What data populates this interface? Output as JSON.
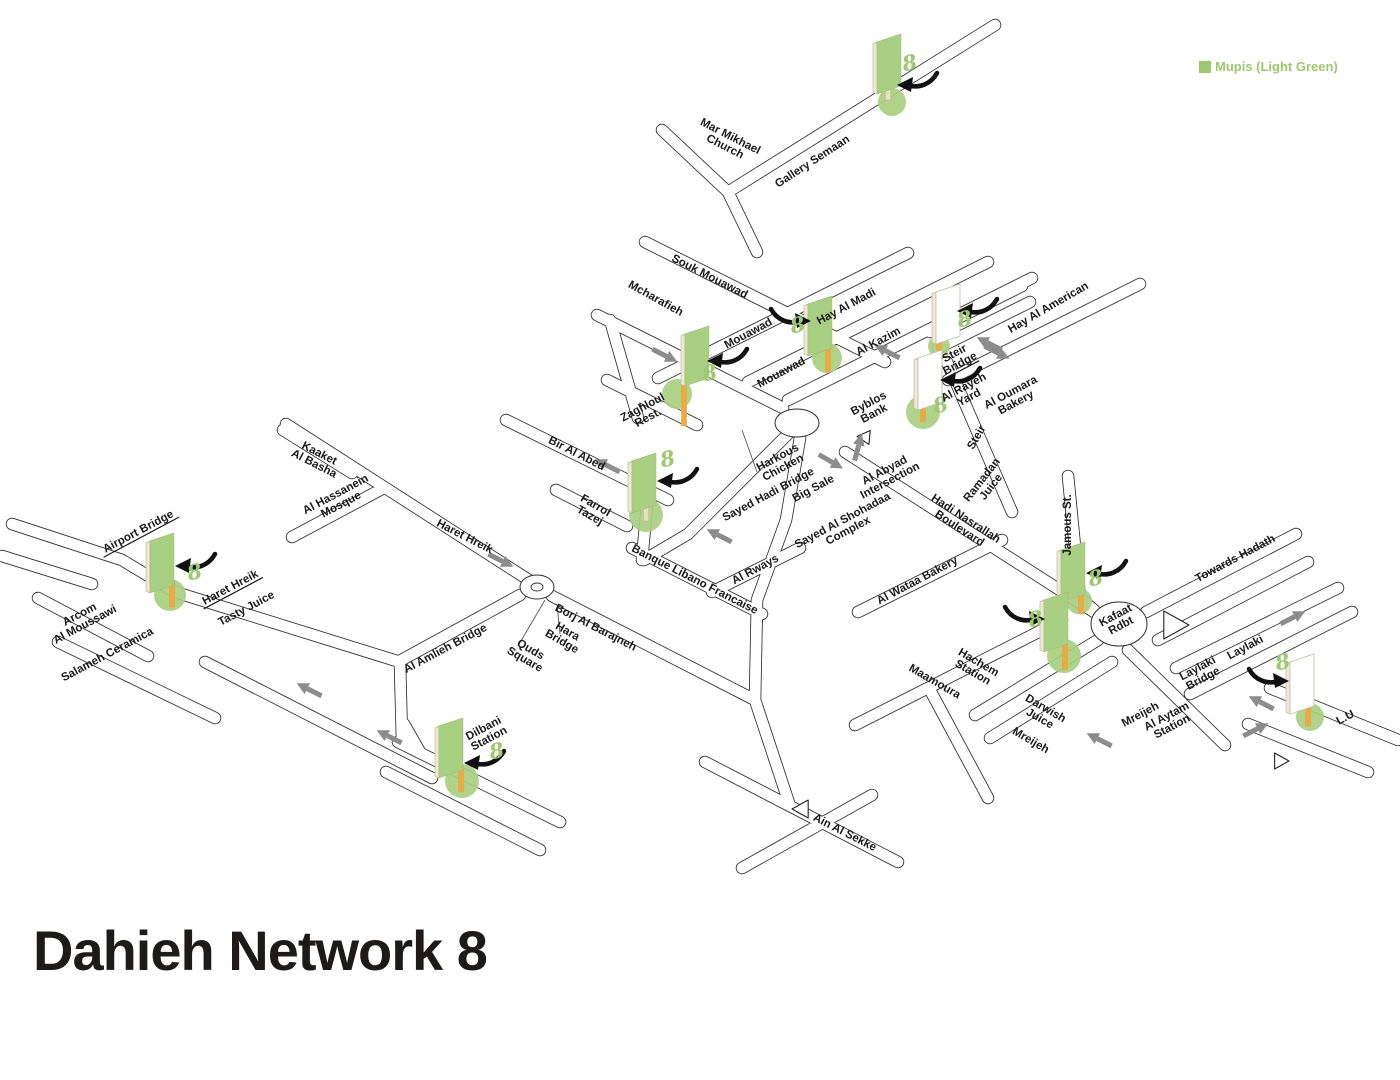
{
  "title": "Dahieh Network 8",
  "legend": {
    "label": "Mupis (Light Green)",
    "color": "#9CC96F"
  },
  "colors": {
    "legend_green": "#9CC96F",
    "mupi_panel_green": "#A9CF82",
    "mupi_panel_back": "#FFFFFF",
    "mupi_edge_cream": "#EFE8D3",
    "mupi_edge_stroke": "#C9C1A8",
    "pole_orange": "#F2A93B",
    "pole_cream": "#E7DEC8",
    "base_circle_green": "#A9CF82",
    "road_line": "#2E2E2E",
    "road_fill": "#FFFFFF",
    "direction_arrow_gray": "#8C8C8C",
    "label_text": "#1A1A1A",
    "marker_arrow_black": "#111111"
  },
  "map": {
    "street_labels": [
      {
        "lines": [
          "Mar Mikhael",
          "Church"
        ],
        "x": 728,
        "y": 141,
        "rot": 27,
        "ul": false
      },
      {
        "lines": [
          "Gallery Semaan"
        ],
        "x": 812,
        "y": 161,
        "rot": -33,
        "ul": false
      },
      {
        "lines": [
          "Souk Mouawad"
        ],
        "x": 710,
        "y": 276,
        "rot": 27,
        "ul": false
      },
      {
        "lines": [
          "Mcharafieh"
        ],
        "x": 656,
        "y": 298,
        "rot": 29,
        "ul": false
      },
      {
        "lines": [
          "Mouawad"
        ],
        "x": 748,
        "y": 333,
        "rot": -28,
        "ul": false
      },
      {
        "lines": [
          "Mouawad"
        ],
        "x": 781,
        "y": 372,
        "rot": -28,
        "ul": false
      },
      {
        "lines": [
          "Hay Al Madi"
        ],
        "x": 846,
        "y": 306,
        "rot": -28,
        "ul": false
      },
      {
        "lines": [
          "Al Kazim"
        ],
        "x": 878,
        "y": 341,
        "rot": -28,
        "ul": false
      },
      {
        "lines": [
          "Hay Al American"
        ],
        "x": 1048,
        "y": 307,
        "rot": -30,
        "ul": false
      },
      {
        "lines": [
          "Steir",
          "Bridge"
        ],
        "x": 957,
        "y": 358,
        "rot": -28,
        "ul": true
      },
      {
        "lines": [
          "Al Rayeh",
          "Yard"
        ],
        "x": 966,
        "y": 392,
        "rot": -28,
        "ul": false
      },
      {
        "lines": [
          "Al Oumara",
          "Bakery"
        ],
        "x": 1013,
        "y": 397,
        "rot": -28,
        "ul": false
      },
      {
        "lines": [
          "Byblos",
          "Bank"
        ],
        "x": 871,
        "y": 408,
        "rot": -28,
        "ul": false
      },
      {
        "lines": [
          "Zaghloul",
          "Rest."
        ],
        "x": 645,
        "y": 412,
        "rot": -28,
        "ul": false
      },
      {
        "lines": [
          "Bir Al Abed"
        ],
        "x": 577,
        "y": 453,
        "rot": 27,
        "ul": false
      },
      {
        "lines": [
          "Harkous",
          "Chicken"
        ],
        "x": 780,
        "y": 462,
        "rot": -28,
        "ul": false
      },
      {
        "lines": [
          "Sayed Hadi Bridge"
        ],
        "x": 768,
        "y": 494,
        "rot": -28,
        "ul": false
      },
      {
        "lines": [
          "Big Sale"
        ],
        "x": 813,
        "y": 488,
        "rot": -28,
        "ul": false
      },
      {
        "lines": [
          "Al Abyad",
          "Intersection"
        ],
        "x": 887,
        "y": 475,
        "rot": -28,
        "ul": false
      },
      {
        "lines": [
          "Ramadan",
          "Juice"
        ],
        "x": 986,
        "y": 483,
        "rot": -52,
        "ul": false
      },
      {
        "lines": [
          "Steir"
        ],
        "x": 976,
        "y": 437,
        "rot": -60,
        "ul": false
      },
      {
        "lines": [
          "Kaaket",
          "Al Basha"
        ],
        "x": 317,
        "y": 458,
        "rot": 27,
        "ul": false
      },
      {
        "lines": [
          "Al Hassanein",
          "Mosque"
        ],
        "x": 338,
        "y": 499,
        "rot": -28,
        "ul": false
      },
      {
        "lines": [
          "Haret Hreik"
        ],
        "x": 465,
        "y": 536,
        "rot": 27,
        "ul": false
      },
      {
        "lines": [
          "Farrol",
          "Tazej"
        ],
        "x": 593,
        "y": 510,
        "rot": 30,
        "ul": false
      },
      {
        "lines": [
          "Sayed Al Shohadaa",
          "Complex"
        ],
        "x": 845,
        "y": 525,
        "rot": -28,
        "ul": false
      },
      {
        "lines": [
          "Hadi Nasrallah",
          "Boulevard"
        ],
        "x": 963,
        "y": 523,
        "rot": 33,
        "ul": false
      },
      {
        "lines": [
          "Jamous St."
        ],
        "x": 1067,
        "y": 525,
        "rot": -90,
        "ul": false
      },
      {
        "lines": [
          "Airport Bridge"
        ],
        "x": 138,
        "y": 531,
        "rot": -28,
        "ul": true
      },
      {
        "lines": [
          "Haret Hreik"
        ],
        "x": 230,
        "y": 587,
        "rot": -28,
        "ul": true
      },
      {
        "lines": [
          "Tasty Juice"
        ],
        "x": 246,
        "y": 608,
        "rot": -28,
        "ul": false
      },
      {
        "lines": [
          "Arcom",
          "Al Moussawi"
        ],
        "x": 82,
        "y": 619,
        "rot": -28,
        "ul": false
      },
      {
        "lines": [
          "Salameh Ceramica"
        ],
        "x": 107,
        "y": 654,
        "rot": -28,
        "ul": false
      },
      {
        "lines": [
          "Banque Libano Francaise"
        ],
        "x": 695,
        "y": 579,
        "rot": 27,
        "ul": false
      },
      {
        "lines": [
          "Al Rways"
        ],
        "x": 755,
        "y": 569,
        "rot": -28,
        "ul": false
      },
      {
        "lines": [
          "Borj Al Barajneh"
        ],
        "x": 596,
        "y": 627,
        "rot": 27,
        "ul": false
      },
      {
        "lines": [
          "Hara",
          "Bridge"
        ],
        "x": 565,
        "y": 636,
        "rot": 30,
        "ul": false
      },
      {
        "lines": [
          "Quds",
          "Square"
        ],
        "x": 528,
        "y": 654,
        "rot": 30,
        "ul": false
      },
      {
        "lines": [
          "Al Amlieh Bridge"
        ],
        "x": 445,
        "y": 648,
        "rot": -28,
        "ul": false
      },
      {
        "lines": [
          "Al Wataa Bakery"
        ],
        "x": 917,
        "y": 580,
        "rot": -28,
        "ul": false
      },
      {
        "lines": [
          "Kafaat",
          "Rdbt"
        ],
        "x": 1118,
        "y": 620,
        "rot": -28,
        "ul": false
      },
      {
        "lines": [
          "Towards Hadath"
        ],
        "x": 1235,
        "y": 558,
        "rot": -28,
        "ul": false
      },
      {
        "lines": [
          "Laylaki"
        ],
        "x": 1245,
        "y": 647,
        "rot": -28,
        "ul": false
      },
      {
        "lines": [
          "Laylaki",
          "Bridge"
        ],
        "x": 1200,
        "y": 673,
        "rot": -28,
        "ul": false
      },
      {
        "lines": [
          "Mreijeh"
        ],
        "x": 1140,
        "y": 714,
        "rot": -28,
        "ul": false
      },
      {
        "lines": [
          "Al Aytam",
          "Station"
        ],
        "x": 1169,
        "y": 721,
        "rot": -28,
        "ul": false
      },
      {
        "lines": [
          "L.U"
        ],
        "x": 1345,
        "y": 717,
        "rot": -28,
        "ul": false
      },
      {
        "lines": [
          "Hachem",
          "Station"
        ],
        "x": 976,
        "y": 667,
        "rot": 30,
        "ul": false
      },
      {
        "lines": [
          "Maamoura"
        ],
        "x": 935,
        "y": 681,
        "rot": 30,
        "ul": false
      },
      {
        "lines": [
          "Darwish",
          "Juice"
        ],
        "x": 1043,
        "y": 713,
        "rot": 30,
        "ul": false
      },
      {
        "lines": [
          "Mreijeh"
        ],
        "x": 1031,
        "y": 740,
        "rot": 30,
        "ul": false
      },
      {
        "lines": [
          "Dilbani",
          "Station"
        ],
        "x": 486,
        "y": 733,
        "rot": -28,
        "ul": false
      },
      {
        "lines": [
          "Ain Al Sekke"
        ],
        "x": 845,
        "y": 832,
        "rot": 27,
        "ul": false
      }
    ],
    "mupis": [
      {
        "x": 889,
        "y": 64,
        "face": "green",
        "pole": {
          "dx": -1,
          "len": 12,
          "color": "cream"
        },
        "circle": {
          "dx": 3,
          "dy": 38,
          "r": 14
        },
        "arrow": {
          "dx": 26,
          "dy": 18,
          "dir": "left"
        },
        "eight": {
          "dx": 22,
          "dy": 6
        }
      },
      {
        "x": 697,
        "y": 356,
        "face": "green",
        "pole": {
          "dx": -13,
          "len": 46,
          "color": "orange"
        },
        "circle": {
          "dx": -20,
          "dy": 38,
          "r": 15
        },
        "arrow": {
          "dx": 28,
          "dy": 2,
          "dir": "left"
        },
        "eight": {
          "dx": 14,
          "dy": 24
        }
      },
      {
        "x": 820,
        "y": 326,
        "face": "green",
        "pole": {
          "dx": 8,
          "len": 22,
          "color": "orange"
        },
        "circle": {
          "dx": 7,
          "dy": 32,
          "r": 15
        },
        "arrow": {
          "dx": -27,
          "dy": -8,
          "dir": "right"
        },
        "eight": {
          "dx": -21,
          "dy": 6
        }
      },
      {
        "x": 948,
        "y": 314,
        "face": "back",
        "pole": {
          "dx": -9,
          "len": 16,
          "color": "orange"
        },
        "circle": {
          "dx": -9,
          "dy": 32,
          "r": 11
        },
        "arrow": {
          "dx": 27,
          "dy": -6,
          "dir": "left"
        },
        "eight": {
          "dx": 18,
          "dy": 12
        }
      },
      {
        "x": 930,
        "y": 380,
        "face": "back",
        "pole": {
          "dx": -7,
          "len": 18,
          "color": "orange"
        },
        "circle": {
          "dx": -7,
          "dy": 32,
          "r": 17
        },
        "arrow": {
          "dx": 28,
          "dy": -3,
          "dir": "left"
        },
        "eight": {
          "dx": 12,
          "dy": 32
        }
      },
      {
        "x": 644,
        "y": 483,
        "face": "green",
        "pole": {
          "dx": 2,
          "len": 14,
          "color": "cream"
        },
        "circle": {
          "dx": 2,
          "dy": 32,
          "r": 17
        },
        "arrow": {
          "dx": 31,
          "dy": -5,
          "dir": "left"
        },
        "eight": {
          "dx": 25,
          "dy": -17
        }
      },
      {
        "x": 162,
        "y": 563,
        "face": "green",
        "pole": {
          "dx": 10,
          "len": 20,
          "color": "orange"
        },
        "circle": {
          "dx": 8,
          "dy": 32,
          "r": 16
        },
        "arrow": {
          "dx": 31,
          "dy": 0,
          "dir": "left"
        },
        "eight": {
          "dx": 34,
          "dy": 16
        }
      },
      {
        "x": 1073,
        "y": 572,
        "face": "green",
        "pole": {
          "dx": 8,
          "len": 18,
          "color": "orange"
        },
        "circle": {
          "dx": 6,
          "dy": 29,
          "r": 13
        },
        "arrow": {
          "dx": 31,
          "dy": -2,
          "dir": "left"
        },
        "eight": {
          "dx": 24,
          "dy": 13
        }
      },
      {
        "x": 1056,
        "y": 622,
        "face": "green",
        "pole": {
          "dx": 9,
          "len": 24,
          "color": "orange"
        },
        "circle": {
          "dx": 8,
          "dy": 34,
          "r": 17
        },
        "arrow": {
          "dx": -29,
          "dy": -6,
          "dir": "right"
        },
        "eight": {
          "dx": -19,
          "dy": 4
        }
      },
      {
        "x": 1302,
        "y": 684,
        "face": "back",
        "pole": {
          "dx": 6,
          "len": 18,
          "color": "orange"
        },
        "circle": {
          "dx": 8,
          "dy": 33,
          "r": 14
        },
        "arrow": {
          "dx": -31,
          "dy": -6,
          "dir": "right"
        },
        "eight": {
          "dx": -18,
          "dy": -15
        }
      },
      {
        "x": 451,
        "y": 748,
        "face": "green",
        "pole": {
          "dx": 10,
          "len": 20,
          "color": "orange"
        },
        "circle": {
          "dx": 11,
          "dy": 33,
          "r": 17
        },
        "arrow": {
          "dx": 31,
          "dy": 12,
          "dir": "left"
        },
        "eight": {
          "dx": 47,
          "dy": 10
        }
      }
    ],
    "road_arrows": [
      {
        "x": 608,
        "y": 466,
        "a": 207
      },
      {
        "x": 888,
        "y": 352,
        "a": 207
      },
      {
        "x": 664,
        "y": 355,
        "a": 27
      },
      {
        "x": 830,
        "y": 461,
        "a": 30
      },
      {
        "x": 858,
        "y": 448,
        "a": -75
      },
      {
        "x": 990,
        "y": 344,
        "a": 207
      },
      {
        "x": 996,
        "y": 352,
        "a": 27
      },
      {
        "x": 500,
        "y": 560,
        "a": 27
      },
      {
        "x": 310,
        "y": 690,
        "a": 207
      },
      {
        "x": 390,
        "y": 737,
        "a": 207
      },
      {
        "x": 1292,
        "y": 618,
        "a": -27
      },
      {
        "x": 1262,
        "y": 703,
        "a": 207
      },
      {
        "x": 1255,
        "y": 730,
        "a": -27
      },
      {
        "x": 1100,
        "y": 740,
        "a": 207
      },
      {
        "x": 720,
        "y": 536,
        "a": 207
      }
    ],
    "triangles": [
      {
        "x": 864,
        "y": 437,
        "a": 185,
        "s": 7
      },
      {
        "x": 1175,
        "y": 625,
        "a": 0,
        "s": 14
      },
      {
        "x": 1281,
        "y": 761,
        "a": 0,
        "s": 8
      },
      {
        "x": 801,
        "y": 809,
        "a": 180,
        "s": 9
      }
    ],
    "roundabouts": [
      {
        "x": 797,
        "y": 423,
        "rx": 22,
        "ry": 14,
        "inner": false
      },
      {
        "x": 537,
        "y": 587,
        "rx": 17,
        "ry": 12,
        "inner": true
      },
      {
        "x": 1119,
        "y": 624,
        "rx": 28,
        "ry": 22,
        "inner": false
      }
    ],
    "roads_path": "M995,25 L728,192 M662,130 L728,192 M728,192 L757,252 M645,242 L885,362 M597,315 L783,408 M607,380 L697,425 M610,320 L638,418 M658,378 L908,253 M748,382 L988,262 M788,400 L1032,278 M948,380 L1140,284 M930,332 L1022,286 M938,348 L1030,302 M947,362 L1012,512 M286,424 L535,584 M283,430 L352,473 M292,537 L380,490 M506,420 L668,500 M556,490 L627,526 M648,494 L642,560 M790,432 L688,534 M688,534 L644,560 M632,548 L762,614 M712,592 L800,548 M398,662 L520,595 M552,596 L755,700 M755,700 L790,806 M705,762 L898,862 M742,868 L872,795 M12,524 L122,560 M2,556 L92,584 M122,560 L175,592 M175,592 L400,662 M38,598 L148,656 M58,642 L215,718 M205,662 L432,778 M400,664 L402,740 M398,742 L560,822 M386,772 L540,850 M404,724 L420,752 M845,452 L1094,612 M858,612 L1002,540 M855,725 L1062,620 M930,690 L988,798 M1068,476 L1080,598 M1080,598 L1094,610 M1146,612 L1296,534 M1158,640 L1308,562 M1176,668 L1338,588 M1190,694 L1352,612 M1270,688 L1398,740 M1248,724 L1368,772 M1098,640 L975,715 M1112,662 L990,738 M1128,650 L1225,745 M800,438 L786,520 M786,520 L757,600 M757,600 L755,700",
    "leader_lines_path": "M518,646 L545,600 M560,634 L557,604 M757,472 L742,430"
  }
}
